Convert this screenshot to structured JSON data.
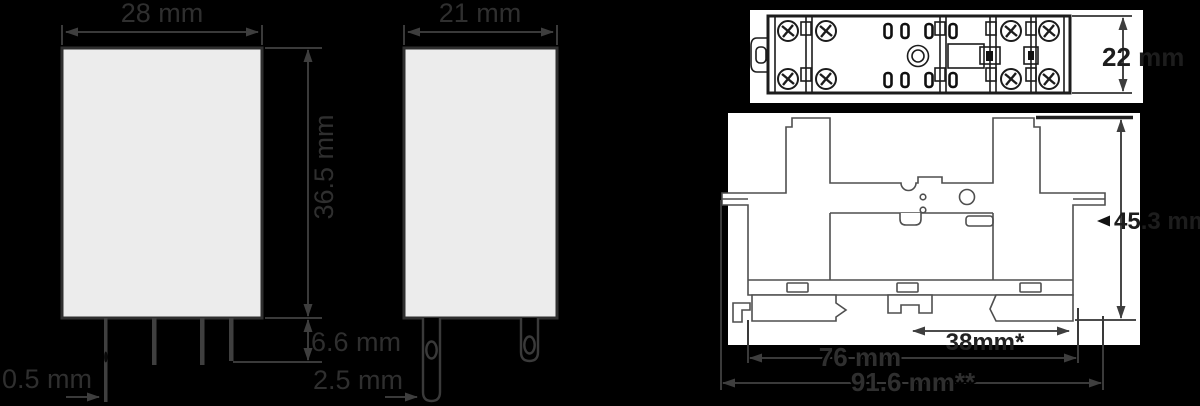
{
  "colors": {
    "background": "#000000",
    "panel": "#ffffff",
    "body_fill": "#ececec",
    "dim_line": "#3a3a3a",
    "drawing_line": "#4f4f4f",
    "label_text": "#2f2f2f"
  },
  "views": {
    "relay_front": {
      "width_label": "28 mm",
      "height_label": "36.5 mm",
      "pin_length_label": "6.6 mm",
      "pin_thickness_label": "0.5 mm"
    },
    "relay_side": {
      "width_label": "21 mm",
      "pin_width_label": "2.5 mm"
    },
    "socket_top": {
      "depth_label": "22 mm"
    },
    "socket_front": {
      "height_label": "45.3 mm",
      "rail_width_label": "38mm*",
      "body_width_label": "76 mm",
      "overall_width_label": "91.6 mm**"
    }
  }
}
